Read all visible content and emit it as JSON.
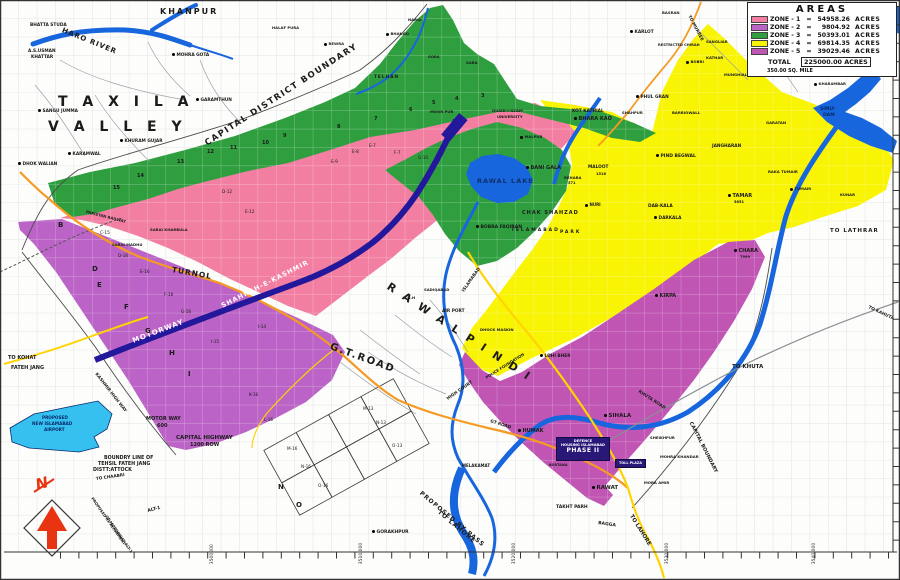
{
  "colors": {
    "zone1": "#f27fa2",
    "zone2": "#bb63c6",
    "zone3": "#2f9e3f",
    "zone4": "#f8f404",
    "zone5": "#c055b4",
    "water": "#1766dd",
    "airport": "#35c0f0",
    "road_orange": "#f59a23",
    "road_yellow": "#ffd400",
    "motorway_band": "#23189b",
    "gray_road": "#8a8f96",
    "boundary": "#4a4a4a",
    "compass_red": "#e83410",
    "grid": "#bcc3ca",
    "street": "#9aa0a8"
  },
  "legend": {
    "title": "AREAS",
    "zones": [
      {
        "label": "ZONE - 1",
        "value": "54958.26",
        "unit": "ACRES",
        "color_key": "zone1"
      },
      {
        "label": "ZONE - 2",
        "value": "9804.92",
        "unit": "ACRES",
        "color_key": "zone2"
      },
      {
        "label": "ZONE - 3",
        "value": "50393.01",
        "unit": "ACRES",
        "color_key": "zone3"
      },
      {
        "label": "ZONE - 4",
        "value": "69814.35",
        "unit": "ACRES",
        "color_key": "zone4"
      },
      {
        "label": "ZONE - 5",
        "value": "39029.46",
        "unit": "ACRES",
        "color_key": "zone5"
      }
    ],
    "total": {
      "label": "TOTAL",
      "value": "225000.00 ACRES"
    },
    "note": "350.00 SQ. MILE"
  },
  "map": {
    "phase2": {
      "line1": "DEFENCE",
      "line2": "HOUSING ISLAMABAD",
      "line3": "PHASE II"
    },
    "toll": "TOLL PLAZA",
    "compass": "N",
    "labels": [
      {
        "t": "KHANPUR",
        "x": 160,
        "y": 8,
        "s": 8,
        "ls": 2
      },
      {
        "t": "HARO RIVER",
        "x": 62,
        "y": 27,
        "s": 7,
        "r": 22,
        "ls": 1
      },
      {
        "t": "BHATTA STUDA",
        "x": 30,
        "y": 24,
        "s": 4.3
      },
      {
        "t": "A.S.USMAN",
        "x": 28,
        "y": 50,
        "s": 4.3
      },
      {
        "t": "KHATTAR",
        "x": 31,
        "y": 56,
        "s": 4.3
      },
      {
        "t": "MOHRA GOTA",
        "x": 172,
        "y": 53,
        "s": 4.3,
        "d": 1
      },
      {
        "t": "T A X I L A",
        "x": 58,
        "y": 95,
        "s": 14,
        "ls": 5
      },
      {
        "t": "V A L L E Y",
        "x": 48,
        "y": 120,
        "s": 14,
        "ls": 5
      },
      {
        "t": "SANGU JUMMA",
        "x": 38,
        "y": 109,
        "s": 4.3,
        "d": 1
      },
      {
        "t": "GARAMTHUN",
        "x": 196,
        "y": 98,
        "s": 4.3,
        "d": 1
      },
      {
        "t": "KARAMWAL",
        "x": 68,
        "y": 152,
        "s": 4.3,
        "d": 1
      },
      {
        "t": "DHOK WALIAN",
        "x": 18,
        "y": 162,
        "s": 4.3,
        "d": 1
      },
      {
        "t": "KHURAM GUJAR",
        "x": 120,
        "y": 139,
        "s": 4.3,
        "d": 1
      },
      {
        "t": "CAPITAL DISTRICT BOUNDARY",
        "x": 206,
        "y": 140,
        "s": 8.5,
        "r": -33,
        "ls": 1.5
      },
      {
        "t": "PAKISTAN RAILWAY",
        "x": 86,
        "y": 210,
        "s": 3.8,
        "r": 14
      },
      {
        "t": "SARAI KHARBULA",
        "x": 150,
        "y": 228,
        "s": 3.8
      },
      {
        "t": "SARAI MADHU",
        "x": 112,
        "y": 243,
        "s": 3.8
      },
      {
        "t": "TURNOL",
        "x": 172,
        "y": 266,
        "s": 7.5,
        "r": 10,
        "ls": 1
      },
      {
        "t": "MOTORWAY",
        "x": 133,
        "y": 338,
        "s": 7,
        "r": -21,
        "c": "#ffffff",
        "ls": 1
      },
      {
        "t": "SHAHRAH-E-KASHMIR",
        "x": 222,
        "y": 303,
        "s": 6.5,
        "r": -27,
        "c": "#ffffff",
        "ls": 1
      },
      {
        "t": "KASHMIR HIGH WAY",
        "x": 95,
        "y": 372,
        "s": 4.3,
        "r": 52
      },
      {
        "t": "TO KOHAT",
        "x": 8,
        "y": 356,
        "s": 5
      },
      {
        "t": "FATEH JANG",
        "x": 11,
        "y": 366,
        "s": 5
      },
      {
        "t": "G.T.ROAD",
        "x": 330,
        "y": 342,
        "s": 10,
        "r": 20,
        "ls": 2
      },
      {
        "t": "R A W A L  P I N D I",
        "x": 388,
        "y": 280,
        "s": 11,
        "r": 33,
        "ls": 3
      },
      {
        "t": "R.G.H",
        "x": 403,
        "y": 296,
        "s": 3.8
      },
      {
        "t": "SADIQABAD",
        "x": 424,
        "y": 288,
        "s": 3.8
      },
      {
        "t": "AIR PORT",
        "x": 442,
        "y": 310,
        "s": 4.3
      },
      {
        "t": "DHOCK MASKIN",
        "x": 480,
        "y": 328,
        "s": 3.8
      },
      {
        "t": "POLICE FOUNDATION",
        "x": 486,
        "y": 376,
        "s": 3.8,
        "r": -32
      },
      {
        "t": "HIGH COURT",
        "x": 448,
        "y": 398,
        "s": 4.3,
        "r": -35
      },
      {
        "t": "ISLAMABAD",
        "x": 464,
        "y": 290,
        "s": 4.3,
        "r": -55
      },
      {
        "t": "RAWAL LAKE",
        "x": 477,
        "y": 178,
        "s": 6.5,
        "ls": 1,
        "c": "#10306a"
      },
      {
        "t": "QUAID-I-AZAM",
        "x": 492,
        "y": 109,
        "s": 3.8
      },
      {
        "t": "UNIVERSITY",
        "x": 497,
        "y": 115,
        "s": 3.8
      },
      {
        "t": "MALPUR",
        "x": 520,
        "y": 135,
        "s": 3.8,
        "d": 1
      },
      {
        "t": "MOOR PUR",
        "x": 430,
        "y": 110,
        "s": 3.8
      },
      {
        "t": "BANI GALA",
        "x": 526,
        "y": 166,
        "s": 5,
        "d": 1
      },
      {
        "t": "KOT KATHIAL",
        "x": 572,
        "y": 110,
        "s": 4.3
      },
      {
        "t": "BHARA KAO",
        "x": 574,
        "y": 117,
        "s": 5,
        "d": 1
      },
      {
        "t": "SHAHPUR",
        "x": 622,
        "y": 111,
        "s": 3.8
      },
      {
        "t": "PHUL GRAN",
        "x": 636,
        "y": 95,
        "s": 4.3,
        "d": 1
      },
      {
        "t": "KARLOT",
        "x": 630,
        "y": 30,
        "s": 4.3,
        "d": 1
      },
      {
        "t": "TO MURREE",
        "x": 688,
        "y": 14,
        "s": 4.3,
        "r": 62
      },
      {
        "t": "RESTRICTED CHIRAH",
        "x": 658,
        "y": 44,
        "s": 3.6
      },
      {
        "t": "SANGLIAR",
        "x": 706,
        "y": 40,
        "s": 3.8
      },
      {
        "t": "KATHAR",
        "x": 706,
        "y": 56,
        "s": 3.8
      },
      {
        "t": "BOBRI",
        "x": 686,
        "y": 60,
        "s": 3.8,
        "d": 1
      },
      {
        "t": "MUNGHIAL",
        "x": 724,
        "y": 73,
        "s": 3.8
      },
      {
        "t": "BARRIOWALL",
        "x": 672,
        "y": 111,
        "s": 3.8
      },
      {
        "t": "GARATAN",
        "x": 766,
        "y": 121,
        "s": 3.8
      },
      {
        "t": "KHARAMBAR",
        "x": 814,
        "y": 82,
        "s": 3.8,
        "d": 1
      },
      {
        "t": "SIMLY",
        "x": 820,
        "y": 108,
        "s": 4.5,
        "c": "#0a2a6a"
      },
      {
        "t": "DAM",
        "x": 823,
        "y": 114,
        "s": 4.5,
        "c": "#0a2a6a"
      },
      {
        "t": "PIND BEGWAL",
        "x": 656,
        "y": 154,
        "s": 4.5,
        "d": 1
      },
      {
        "t": "JANGHARAN",
        "x": 712,
        "y": 145,
        "s": 4.3
      },
      {
        "t": "MALOOT",
        "x": 588,
        "y": 166,
        "s": 4.3
      },
      {
        "t": "1516",
        "x": 596,
        "y": 173,
        "s": 3.6
      },
      {
        "t": "REHARA",
        "x": 564,
        "y": 176,
        "s": 3.8
      },
      {
        "t": "571",
        "x": 568,
        "y": 182,
        "s": 3.6
      },
      {
        "t": "NURI",
        "x": 585,
        "y": 203,
        "s": 4,
        "d": 1
      },
      {
        "t": "CHAK SHAHZAD",
        "x": 522,
        "y": 211,
        "s": 5,
        "ls": 1
      },
      {
        "t": "ISLAMABAD",
        "x": 512,
        "y": 229,
        "s": 4.5,
        "ls": 2
      },
      {
        "t": "PARK",
        "x": 560,
        "y": 231,
        "s": 4.5,
        "ls": 2
      },
      {
        "t": "BOBRA FAQIRAN",
        "x": 476,
        "y": 225,
        "s": 4.5,
        "d": 1
      },
      {
        "t": "RAKA TUMAIR",
        "x": 768,
        "y": 170,
        "s": 3.8
      },
      {
        "t": "TUMAIR",
        "x": 790,
        "y": 187,
        "s": 3.8,
        "d": 1
      },
      {
        "t": "KUNAR",
        "x": 840,
        "y": 193,
        "s": 3.8
      },
      {
        "t": "TAMAR",
        "x": 728,
        "y": 194,
        "s": 5,
        "d": 1
      },
      {
        "t": "5651",
        "x": 734,
        "y": 201,
        "s": 3.6
      },
      {
        "t": "DAB-KALA",
        "x": 648,
        "y": 205,
        "s": 4.3
      },
      {
        "t": "DARKALA",
        "x": 654,
        "y": 216,
        "s": 4.3,
        "d": 1
      },
      {
        "t": "TO LATHRAR",
        "x": 830,
        "y": 229,
        "s": 5.5,
        "ls": 1
      },
      {
        "t": "TO KAHUTA",
        "x": 868,
        "y": 306,
        "s": 4.3,
        "r": 25
      },
      {
        "t": "CHARA",
        "x": 734,
        "y": 249,
        "s": 5,
        "d": 1
      },
      {
        "t": "7999",
        "x": 740,
        "y": 256,
        "s": 3.6
      },
      {
        "t": "KIRPA",
        "x": 655,
        "y": 294,
        "s": 5,
        "d": 1
      },
      {
        "t": "LOHI BHER",
        "x": 540,
        "y": 354,
        "s": 4.3,
        "d": 1
      },
      {
        "t": "TO KHUTA",
        "x": 732,
        "y": 365,
        "s": 5.5
      },
      {
        "t": "CAPITAL BOUNDARY",
        "x": 690,
        "y": 420,
        "s": 5,
        "r": 63
      },
      {
        "t": "KHUTA ROAD",
        "x": 638,
        "y": 390,
        "s": 4.3,
        "r": 33
      },
      {
        "t": "SIHALA",
        "x": 604,
        "y": 414,
        "s": 5.5,
        "d": 1
      },
      {
        "t": "SHEIKHPUR",
        "x": 650,
        "y": 436,
        "s": 3.8
      },
      {
        "t": "MOHRA KHANDAR",
        "x": 660,
        "y": 455,
        "s": 3.8
      },
      {
        "t": "MORA AMIR",
        "x": 644,
        "y": 481,
        "s": 3.8
      },
      {
        "t": "HUMAK",
        "x": 518,
        "y": 429,
        "s": 5,
        "d": 1
      },
      {
        "t": "GT ROAD",
        "x": 490,
        "y": 420,
        "s": 4.3,
        "r": 18
      },
      {
        "t": "KORTANA",
        "x": 549,
        "y": 464,
        "s": 3.5
      },
      {
        "t": "RAWAT",
        "x": 592,
        "y": 486,
        "s": 5.5,
        "d": 1
      },
      {
        "t": "TAKHT PARH",
        "x": 556,
        "y": 506,
        "s": 4.5
      },
      {
        "t": "BAGGA",
        "x": 598,
        "y": 522,
        "s": 4.5,
        "r": 8
      },
      {
        "t": "TO LAHORE",
        "x": 630,
        "y": 513,
        "s": 5.5,
        "r": 58
      },
      {
        "t": "GORAKHPUR",
        "x": 372,
        "y": 530,
        "s": 4.5,
        "d": 1
      },
      {
        "t": "MELAKAMAT",
        "x": 462,
        "y": 464,
        "s": 4
      },
      {
        "t": "PROPOSED BY PASS",
        "x": 420,
        "y": 490,
        "s": 6,
        "r": 40,
        "ls": 1
      },
      {
        "t": "TO LAHORE",
        "x": 438,
        "y": 509,
        "s": 6,
        "r": 40,
        "ls": 1
      },
      {
        "t": "PROPOSED",
        "x": 42,
        "y": 416,
        "s": 4.2,
        "c": "#0a2a6a"
      },
      {
        "t": "NEW ISLAMABAD",
        "x": 32,
        "y": 422,
        "s": 4.2,
        "c": "#0a2a6a"
      },
      {
        "t": "AIRPORT",
        "x": 44,
        "y": 428,
        "s": 4.2,
        "c": "#0a2a6a"
      },
      {
        "t": "MOTOR WAY",
        "x": 146,
        "y": 417,
        "s": 5
      },
      {
        "t": "600",
        "x": 157,
        "y": 424,
        "s": 5
      },
      {
        "t": "CAPITAL HIGHWAY",
        "x": 176,
        "y": 436,
        "s": 5.5
      },
      {
        "t": "1200 ROW",
        "x": 190,
        "y": 443,
        "s": 5
      },
      {
        "t": "BOUNDRY LINE OF",
        "x": 104,
        "y": 457,
        "s": 4.8
      },
      {
        "t": "TEHSIL FATEH JANG",
        "x": 98,
        "y": 463,
        "s": 4.8
      },
      {
        "t": "DISTT:ATTOCK",
        "x": 93,
        "y": 469,
        "s": 4.8
      },
      {
        "t": "TO CHAABRI",
        "x": 96,
        "y": 477,
        "s": 4.2,
        "r": -8
      },
      {
        "t": "PROPOSED RE ALIGNMENT",
        "x": 92,
        "y": 496,
        "s": 3.8,
        "r": 55
      },
      {
        "t": "OF MOTORWAY ALT-1",
        "x": 106,
        "y": 514,
        "s": 3.8,
        "r": 55
      },
      {
        "t": "ALT-1",
        "x": 148,
        "y": 510,
        "s": 4.5,
        "r": -15
      },
      {
        "t": "TELHAN",
        "x": 374,
        "y": 76,
        "s": 4.3,
        "ls": 1
      },
      {
        "t": "SARA",
        "x": 466,
        "y": 61,
        "s": 3.8
      },
      {
        "t": "GORA",
        "x": 428,
        "y": 56,
        "s": 3.6
      },
      {
        "t": "HALAF PURA",
        "x": 272,
        "y": 26,
        "s": 3.8
      },
      {
        "t": "REWRA",
        "x": 324,
        "y": 42,
        "s": 3.8,
        "d": 1
      },
      {
        "t": "BHANGO",
        "x": 386,
        "y": 32,
        "s": 3.8,
        "d": 1
      },
      {
        "t": "NARGI",
        "x": 408,
        "y": 18,
        "s": 3.8
      },
      {
        "t": "BASRAN",
        "x": 662,
        "y": 11,
        "s": 3.8
      },
      {
        "t": "15",
        "x": 113,
        "y": 186,
        "s": 5
      },
      {
        "t": "14",
        "x": 137,
        "y": 174,
        "s": 5
      },
      {
        "t": "13",
        "x": 177,
        "y": 160,
        "s": 5
      },
      {
        "t": "12",
        "x": 207,
        "y": 150,
        "s": 5
      },
      {
        "t": "11",
        "x": 230,
        "y": 146,
        "s": 5
      },
      {
        "t": "10",
        "x": 262,
        "y": 141,
        "s": 5
      },
      {
        "t": "9",
        "x": 283,
        "y": 134,
        "s": 5
      },
      {
        "t": "8",
        "x": 337,
        "y": 125,
        "s": 5
      },
      {
        "t": "7",
        "x": 374,
        "y": 117,
        "s": 5
      },
      {
        "t": "6",
        "x": 409,
        "y": 108,
        "s": 5
      },
      {
        "t": "5",
        "x": 432,
        "y": 101,
        "s": 5
      },
      {
        "t": "4",
        "x": 455,
        "y": 97,
        "s": 5
      },
      {
        "t": "3",
        "x": 481,
        "y": 94,
        "s": 5
      },
      {
        "t": "D-12",
        "x": 222,
        "y": 190,
        "s": 4.2,
        "w": 500
      },
      {
        "t": "E-12",
        "x": 245,
        "y": 210,
        "s": 4.2,
        "w": 500
      },
      {
        "t": "C-15",
        "x": 100,
        "y": 231,
        "s": 4.2,
        "w": 500
      },
      {
        "t": "D-16",
        "x": 118,
        "y": 254,
        "s": 4.2,
        "w": 500
      },
      {
        "t": "E-16",
        "x": 140,
        "y": 270,
        "s": 4.2,
        "w": 500
      },
      {
        "t": "F-16",
        "x": 164,
        "y": 293,
        "s": 4.2,
        "w": 500
      },
      {
        "t": "G-16",
        "x": 181,
        "y": 310,
        "s": 4.2,
        "w": 500
      },
      {
        "t": "I-14",
        "x": 258,
        "y": 325,
        "s": 4.2,
        "w": 500
      },
      {
        "t": "I-15",
        "x": 211,
        "y": 340,
        "s": 4.2,
        "w": 500
      },
      {
        "t": "E-7",
        "x": 369,
        "y": 144,
        "s": 4.2,
        "w": 500
      },
      {
        "t": "E-8",
        "x": 352,
        "y": 150,
        "s": 4.2,
        "w": 500
      },
      {
        "t": "F-7",
        "x": 394,
        "y": 151,
        "s": 4.2,
        "w": 500
      },
      {
        "t": "E-9",
        "x": 331,
        "y": 160,
        "s": 4.2,
        "w": 500
      },
      {
        "t": "G-10",
        "x": 418,
        "y": 156,
        "s": 4.2,
        "w": 500
      },
      {
        "t": "K-16",
        "x": 249,
        "y": 393,
        "s": 4.2,
        "w": 500
      },
      {
        "t": "L-16",
        "x": 264,
        "y": 418,
        "s": 4.2,
        "w": 500
      },
      {
        "t": "M-16",
        "x": 287,
        "y": 447,
        "s": 4.2,
        "w": 500
      },
      {
        "t": "N-16",
        "x": 301,
        "y": 465,
        "s": 4.2,
        "w": 500
      },
      {
        "t": "O-16",
        "x": 318,
        "y": 484,
        "s": 4.2,
        "w": 500
      },
      {
        "t": "M-13",
        "x": 363,
        "y": 407,
        "s": 4.2,
        "w": 500
      },
      {
        "t": "N-13",
        "x": 376,
        "y": 421,
        "s": 4.2,
        "w": 500
      },
      {
        "t": "O-13",
        "x": 392,
        "y": 444,
        "s": 4.2,
        "w": 500
      },
      {
        "t": "B",
        "x": 58,
        "y": 222,
        "s": 7
      },
      {
        "t": "D",
        "x": 92,
        "y": 266,
        "s": 7
      },
      {
        "t": "E",
        "x": 97,
        "y": 282,
        "s": 7
      },
      {
        "t": "F",
        "x": 124,
        "y": 304,
        "s": 7
      },
      {
        "t": "G",
        "x": 145,
        "y": 328,
        "s": 7
      },
      {
        "t": "H",
        "x": 169,
        "y": 350,
        "s": 7
      },
      {
        "t": "I",
        "x": 188,
        "y": 371,
        "s": 7
      },
      {
        "t": "N",
        "x": 278,
        "y": 484,
        "s": 7
      },
      {
        "t": "O",
        "x": 296,
        "y": 502,
        "s": 7
      },
      {
        "t": "3500000",
        "x": 213,
        "y": 562,
        "s": 4.5,
        "r": -90,
        "w": 500
      },
      {
        "t": "3510,000",
        "x": 362,
        "y": 562,
        "s": 4.5,
        "r": -90,
        "w": 500
      },
      {
        "t": "3520,000",
        "x": 515,
        "y": 562,
        "s": 4.5,
        "r": -90,
        "w": 500
      },
      {
        "t": "3530,000",
        "x": 668,
        "y": 562,
        "s": 4.5,
        "r": -90,
        "w": 500
      },
      {
        "t": "3540,000",
        "x": 815,
        "y": 562,
        "s": 4.5,
        "r": -90,
        "w": 500
      }
    ]
  }
}
